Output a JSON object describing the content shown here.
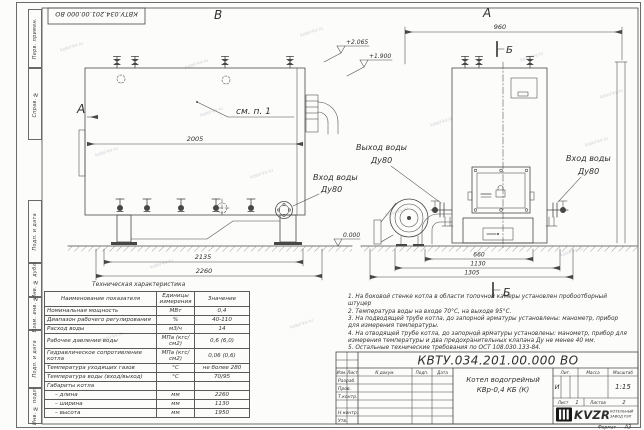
{
  "doc": {
    "designation": "КВТУ.034.201.00.000 ВО",
    "format_label": "Формат",
    "format_value": "А3"
  },
  "watermark": {
    "text": "kotel-kv.ru"
  },
  "margin_column": {
    "labels": [
      "Перв. примен.",
      "Справ. №",
      "Подп. и дата",
      "Инв. № дубл.",
      "Взам. инв. №",
      "Подп. и дата",
      "Инв. № подл."
    ]
  },
  "drawing": {
    "view_labels": {
      "top_left": "В",
      "top_right": "А",
      "side": "А",
      "section_top": "Б",
      "section_bottom": "Б"
    },
    "annotations": {
      "see_item": "см. п. 1"
    },
    "elevations": {
      "e1": "+2.065",
      "e2": "+1.900",
      "e3": "0.000"
    },
    "dims": {
      "d2005": "2005",
      "d2135": "2135",
      "d2260": "2260",
      "d960": "960",
      "d660": "660",
      "d1130": "1130",
      "d1305": "1305"
    },
    "ports": {
      "left_inlet_l1": "Вход воды",
      "left_inlet_l2": "Ду80",
      "outlet_l1": "Выход воды",
      "outlet_l2": "Ду80",
      "right_inlet_l1": "Вход воды",
      "right_inlet_l2": "Ду80"
    }
  },
  "tech_table": {
    "title": "Техническая характеристика",
    "headers": [
      "Наименование показателя",
      "Единицы измерения",
      "Значение"
    ],
    "rows": [
      [
        "Номинальная мощность",
        "МВт",
        "0,4"
      ],
      [
        "Диапазон рабочего регулирования",
        "%",
        "40-110"
      ],
      [
        "Расход воды",
        "м3/ч",
        "14"
      ],
      [
        "Рабочее давление воды",
        "МПа (кгс/см2)",
        "0,6 (6,0)"
      ],
      [
        "Гидравлическое сопротивление котла",
        "МПа (кгс/см2)",
        "0,06 (0,6)"
      ],
      [
        "Температура уходящих газов",
        "°С",
        "не более 280"
      ],
      [
        "Температура воды (вход/выход)",
        "°С",
        "70/95"
      ],
      [
        "Габариты котла",
        "",
        ""
      ],
      [
        "– длина",
        "мм",
        "2260"
      ],
      [
        "– ширина",
        "мм",
        "1130"
      ],
      [
        "– высота",
        "мм",
        "1950"
      ]
    ]
  },
  "notes": [
    "1.  На боковой стенке котла в области топочной камеры установлен пробоотборный штуцер",
    "2.  Температура воды на входе 70°С, на выходе 95°С.",
    "3.  На подводящей трубе котла, до запорной арматуры установлены: манометр, прибор для измерения температуры.",
    "4.  На отводящей трубе котла, до запорной арматуры установлены: манометр, прибор для измерения температуры и два предохранительных клапана Ду не менее 40 мм.",
    "5.  Остальные технические требования по ОСТ 108.030.133-84."
  ],
  "title_block": {
    "designation": "КВТУ.034.201.00.000 ВО",
    "product_name_l1": "Котел водогрейный",
    "product_name_l2": "КВр-0,4  КБ  (К)",
    "rev_headers": [
      "Изм.",
      "Лист",
      "N докум.",
      "Подп.",
      "Дата"
    ],
    "row_labels": [
      "Разраб.",
      "Пров.",
      "Т.контр.",
      "Н.контр.",
      "Утв."
    ],
    "lit_label": "Лит.",
    "lit_value": "И",
    "mass_label": "Масса",
    "scale_label": "Масштаб",
    "scale_value": "1:15",
    "sheet_label": "Лист",
    "sheet_value": "1",
    "sheets_label": "Листов",
    "sheets_value": "2",
    "company": {
      "logo_text": "KVZR",
      "name_l1": "КОТЕЛЬНЫЙ",
      "name_l2": "ЗАВОД РЭП"
    }
  }
}
